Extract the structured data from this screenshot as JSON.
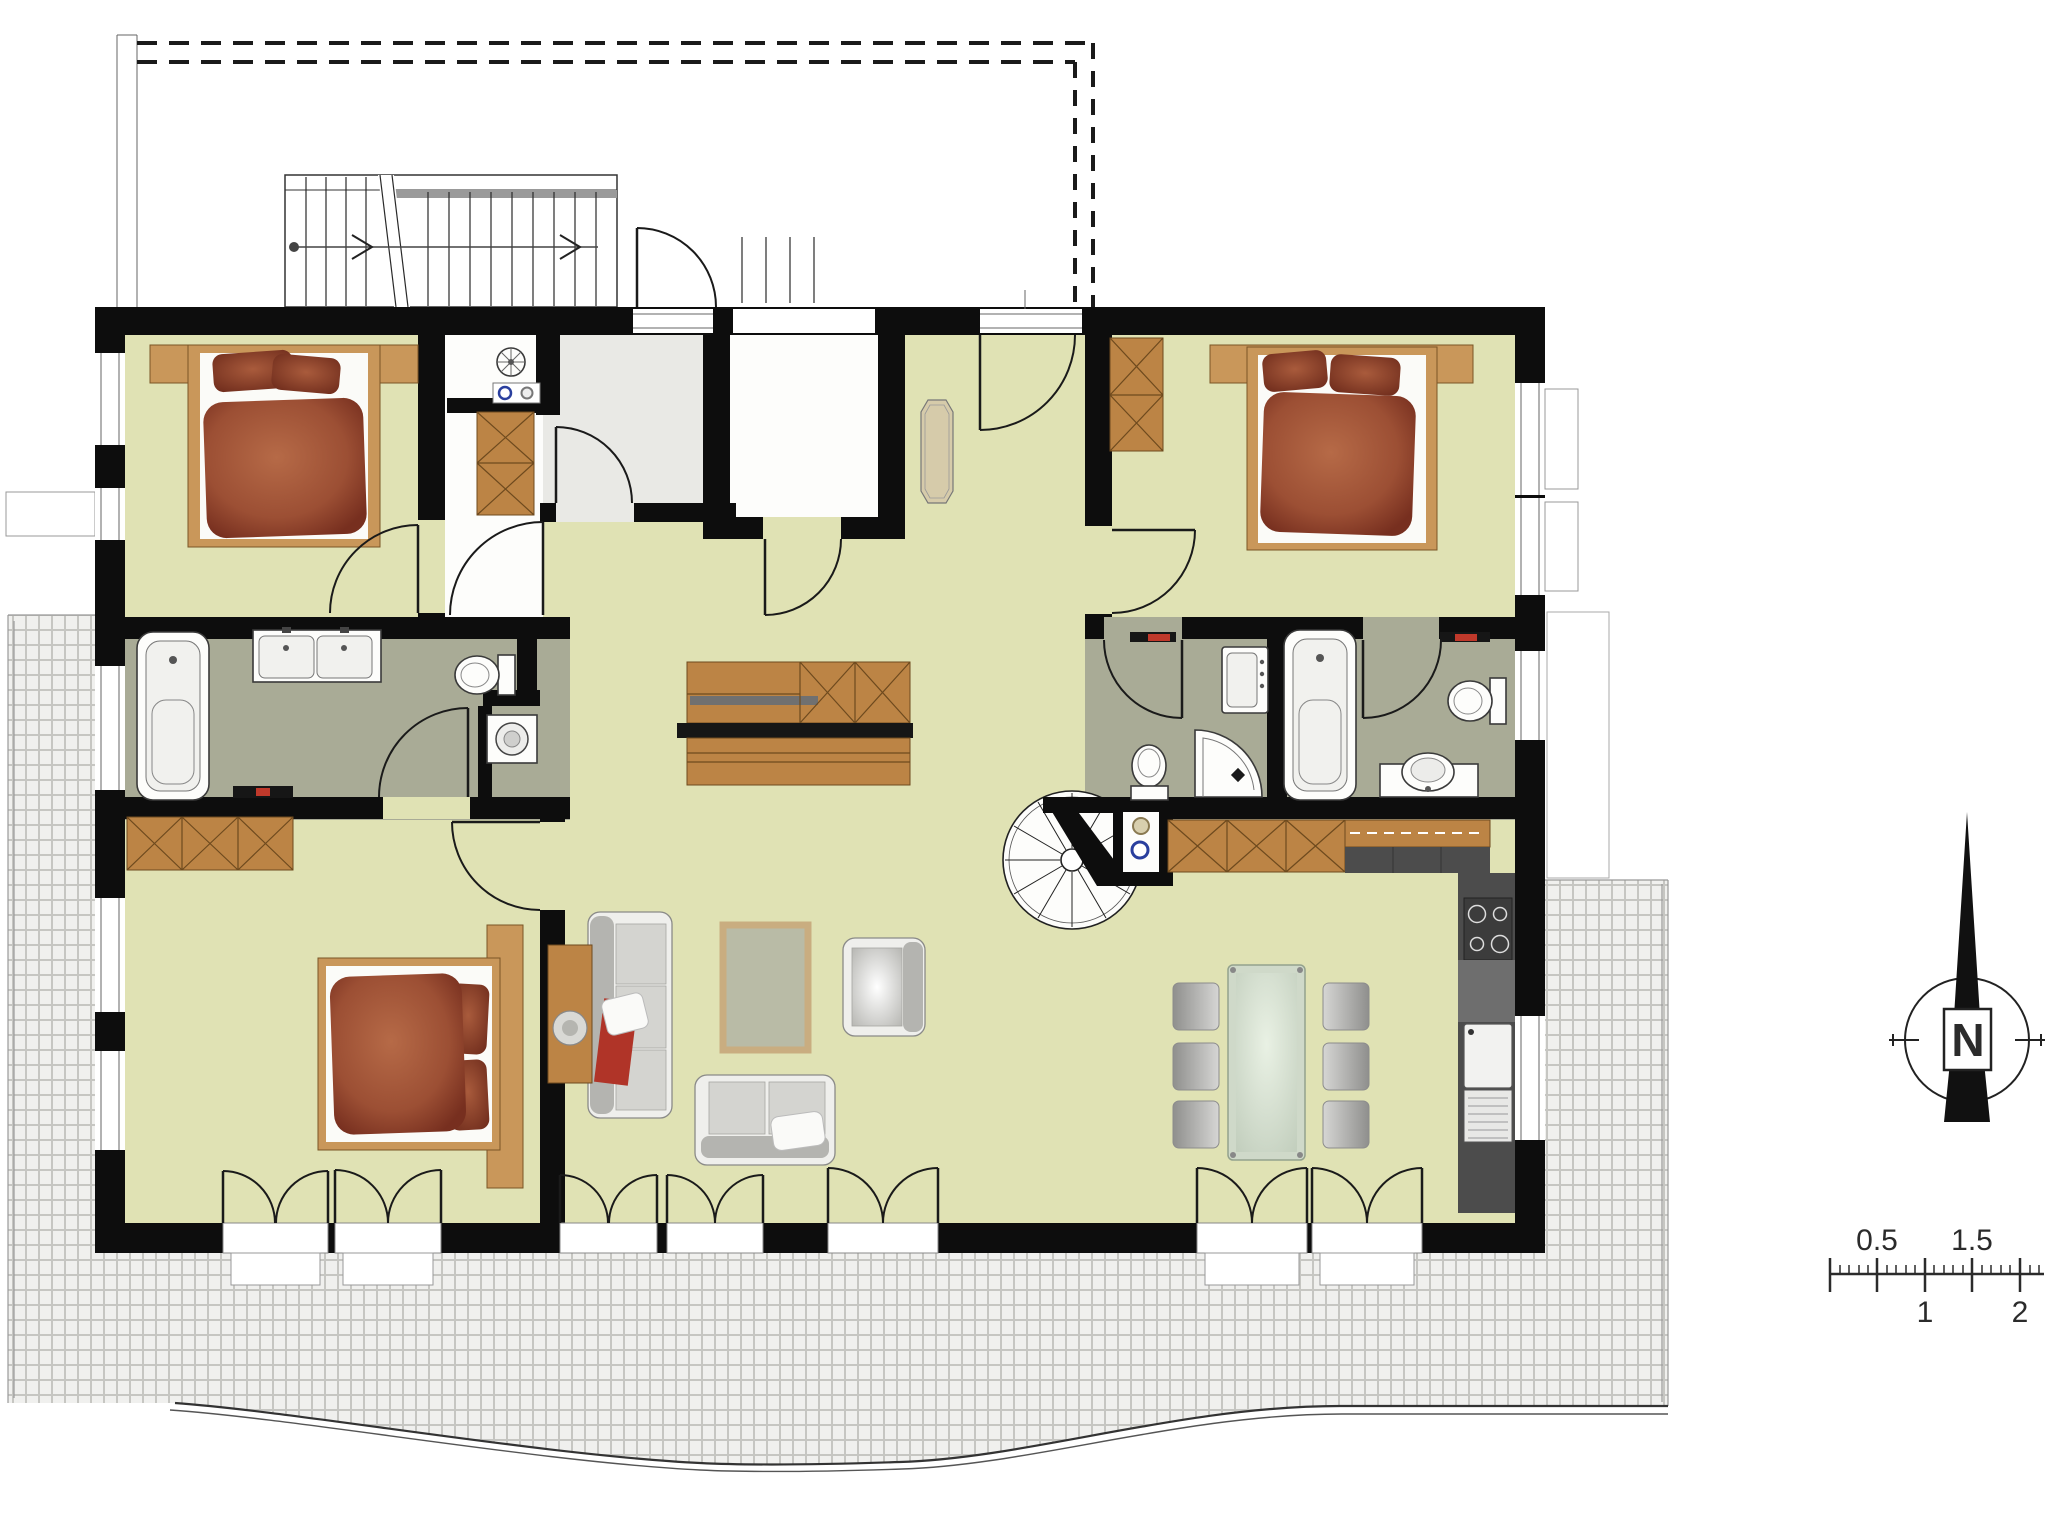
{
  "compass": {
    "label": "N",
    "icon": "north-arrow-icon"
  },
  "scale_bar": {
    "label_0_5": "0.5",
    "label_1": "1",
    "label_1_5": "1.5",
    "label_2": "2",
    "tick_values": [
      0,
      0.5,
      1,
      1.5,
      2
    ]
  },
  "colors": {
    "wall": "#0d0d0d",
    "floor": "#e0e2b4",
    "bath_floor": "#a9ab96",
    "vestibule_floor": "#e9e9e5",
    "wood": "#c9975a",
    "wood_dark": "#bc8445",
    "kitchen_dark": "#4c4c4c",
    "accent_red": "#c0392b",
    "terrace_tile": "#f0f0ee",
    "tile_line": "#c6c6c2",
    "line": "#1a1a1a",
    "rug": "#b9bba6",
    "rug_border": "#c9ad80",
    "glass": "#cfd9c9",
    "duvet": "#9c4f34",
    "duvet_dark": "#772f1f"
  },
  "icons": [
    "north-arrow-icon",
    "scale-ruler-icon",
    "double-bed-icon",
    "wardrobe-icon",
    "bathtub-icon",
    "shower-icon",
    "toilet-icon",
    "double-sink-icon",
    "washing-machine-icon",
    "sofa-icon",
    "loveseat-icon",
    "armchair-icon",
    "coffee-table-icon",
    "rug-icon",
    "dining-table-icon",
    "chair-icon",
    "kitchen-counter-icon",
    "stove-icon",
    "kitchen-sink-icon",
    "spiral-staircase-icon",
    "staircase-icon",
    "door-swing-icon",
    "french-door-icon",
    "terrace-tiles-icon",
    "roof-outline-icon",
    "sideboard-icon"
  ]
}
